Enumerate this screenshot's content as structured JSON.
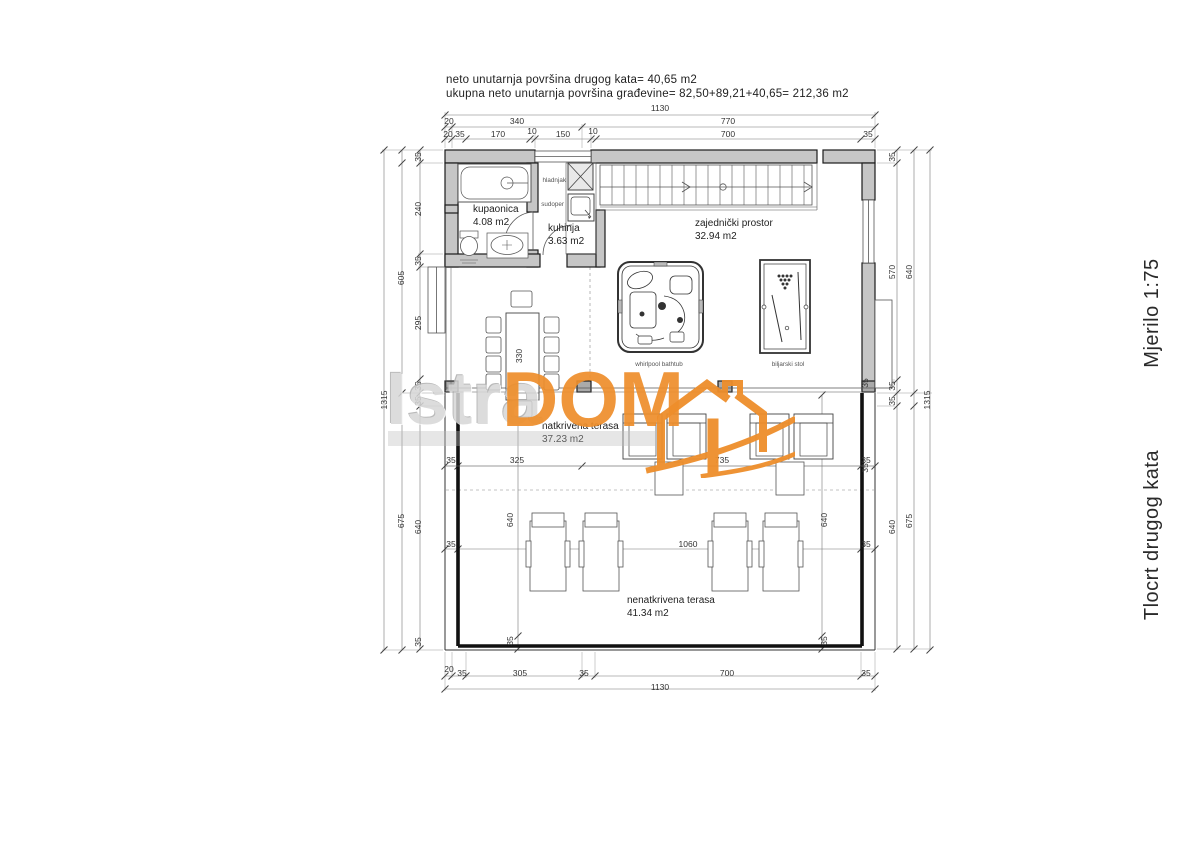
{
  "header": {
    "line1": "neto unutarnja površina drugog kata= 40,65 m2",
    "line2": "ukupna neto unutarnja površina građevine= 82,50+89,21+40,65= 212,36 m2"
  },
  "title_block": {
    "drawing_title": "Tlocrt drugog kata",
    "scale": "Mjerilo 1:75"
  },
  "watermark": {
    "gray": "Istra",
    "orange": "DOM",
    "orange_color": "#ee8e2b"
  },
  "rooms": {
    "bathroom": {
      "name": "kupaonica",
      "area": "4.08 m2"
    },
    "kitchen": {
      "name": "kuhinja",
      "area": "3.63 m2"
    },
    "living": {
      "name": "zajednički prostor",
      "area": "32.94 m2"
    },
    "covered_terrace": {
      "name": "natkrivena terasa",
      "area": "37.23 m2"
    },
    "open_terrace": {
      "name": "nenatkrivena terasa",
      "area": "41.34 m2"
    }
  },
  "fixtures": {
    "fridge": "hladnjak",
    "sink": "sudoper",
    "whirlpool": "whirlpool bathtub",
    "billiard": "biljarski stol",
    "table_length": "330"
  },
  "dims": {
    "top_total": "1130",
    "top_20": "20",
    "top_340": "340",
    "top_770": "770",
    "t3_20": "20",
    "t3_35a": "35",
    "t3_170": "170",
    "t3_10a": "10",
    "t3_150": "150",
    "t3_10b": "10",
    "t3_700": "700",
    "t3_35b": "35",
    "left_1315": "1315",
    "left_605": "605",
    "left_675": "675",
    "l_35a": "35",
    "l_240": "240",
    "l_35b": "35",
    "l_295": "295",
    "l_35c": "35",
    "l_35d": "35",
    "l_640": "640",
    "l_35e": "35",
    "right_1315": "1315",
    "right_640a": "640",
    "right_675": "675",
    "r_35a": "35",
    "r_570": "570",
    "r_35b": "35",
    "r_35c": "35",
    "r_640": "640",
    "r_35w1": "35",
    "r_35w2": "35",
    "ter_35a": "35",
    "ter_325": "325",
    "ter_735": "735",
    "ter_35b": "35",
    "mid_35a": "35",
    "mid_1060": "1060",
    "mid_35b": "35",
    "in_640a": "640",
    "in_35a": "35",
    "in_640b": "640",
    "in_35b": "35",
    "bot_20": "20",
    "bot_35a": "35",
    "bot_305": "305",
    "bot_35b": "35",
    "bot_700": "700",
    "bot_35c": "35",
    "bot_total": "1130"
  }
}
